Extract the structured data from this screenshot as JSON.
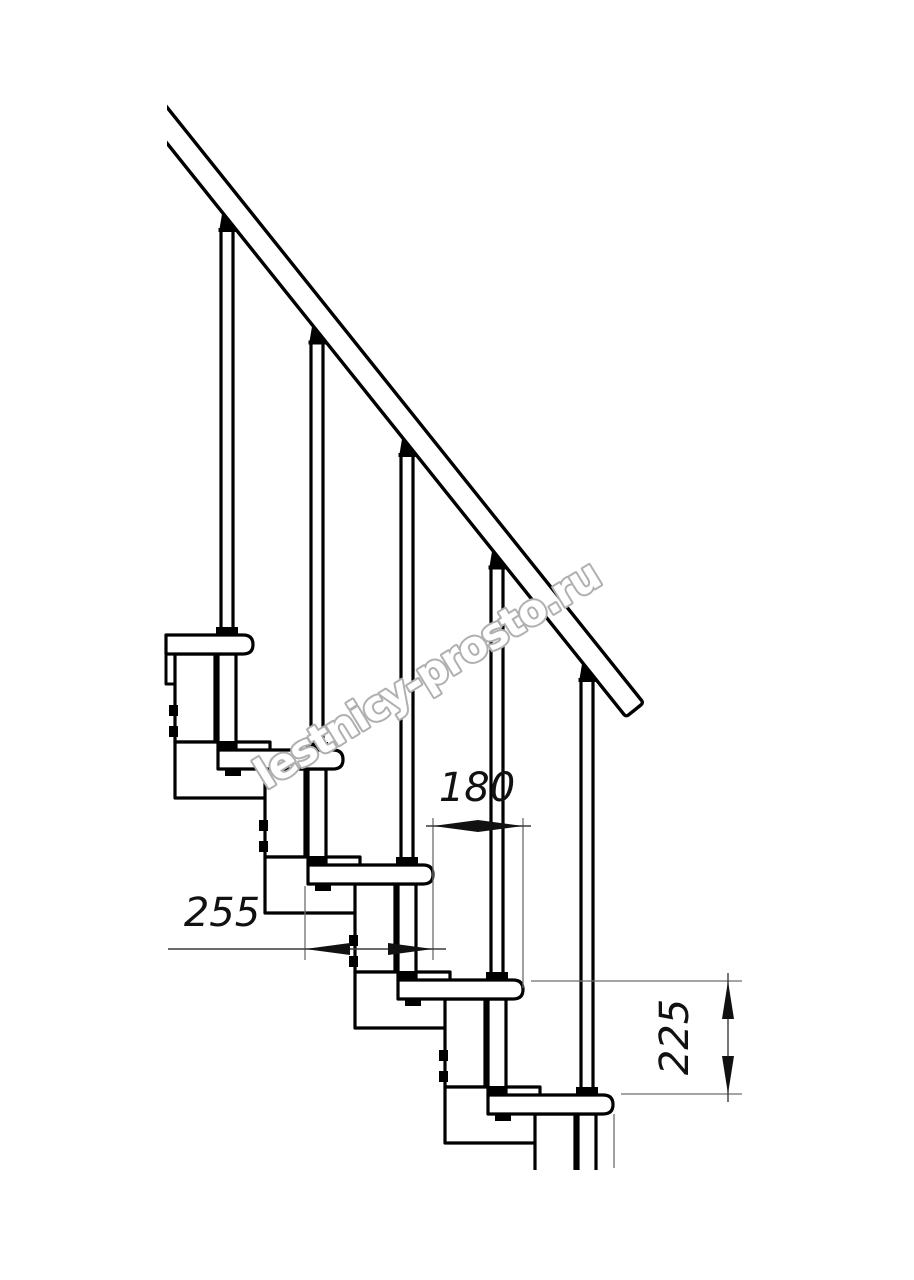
{
  "page": {
    "background": "#ffffff"
  },
  "drawing": {
    "title": "modular staircase side elevation",
    "dimensions": {
      "run": {
        "value": "180"
      },
      "depth": {
        "value": "255"
      },
      "rise": {
        "value": "225"
      }
    },
    "watermark": {
      "text": "lestnicy-prosto.ru",
      "outline_color": "#b0b0b0"
    },
    "colors": {
      "line": "#000000",
      "dimension_line": "#3c3c3c",
      "extension_line": "#6e6e6e",
      "annotation": "#111111",
      "watermark_outline": "#b0b0b0",
      "background": "#ffffff"
    }
  }
}
